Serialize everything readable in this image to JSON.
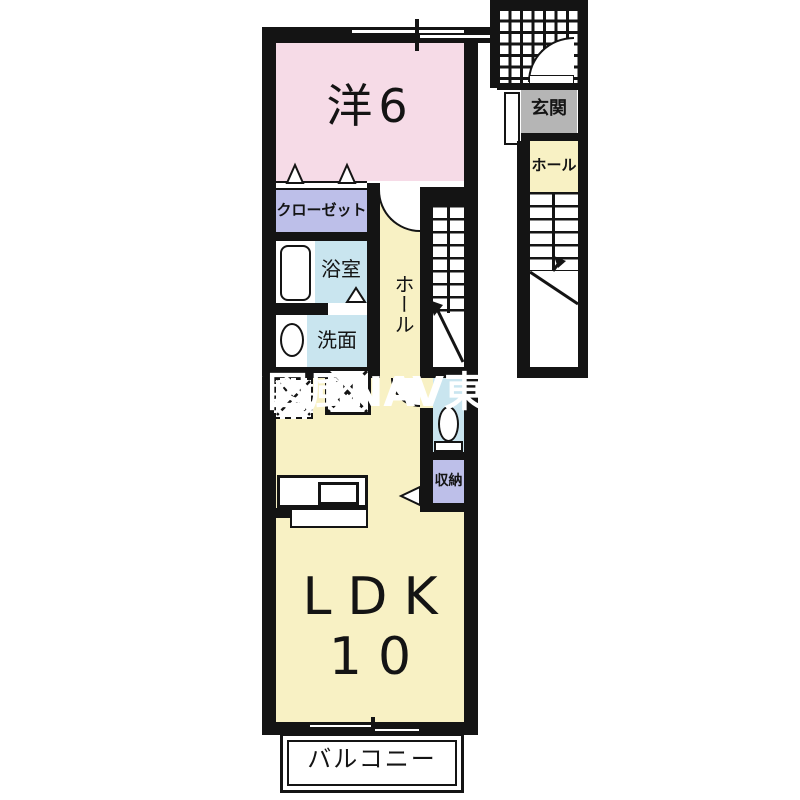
{
  "floorplan": {
    "rooms": {
      "western_room": {
        "label": "洋6"
      },
      "closet": {
        "label": "クローゼット"
      },
      "bathroom": {
        "label": "浴室"
      },
      "washroom": {
        "label": "洗面"
      },
      "hall": {
        "label": "ホール"
      },
      "storage": {
        "label": "収納"
      },
      "ldk": {
        "name": "LDK",
        "size": "10"
      },
      "balcony": {
        "label": "バルコニー"
      },
      "entrance": {
        "label": "玄関"
      },
      "entrance_hall": {
        "label": "ホール"
      }
    },
    "watermark": {
      "text": "イ図風NAV東P",
      "color": "#ffffff"
    },
    "colors": {
      "room_pink": "#f6dbe7",
      "room_yellow": "#f8f1c4",
      "room_blue": "#c9e5ef",
      "room_lavender": "#bdbfe9",
      "entrance_gray": "#b5b5b5",
      "wall": "#141414",
      "background": "#ffffff"
    },
    "symbols": {
      "bathtub": "rounded-rectangle",
      "washbasin": "ellipse",
      "toilet": "ellipse-with-tank",
      "kitchen-sink": "inset-rectangle",
      "stairs": "treads-with-direction-line-and-arrow",
      "door-swing": "quarter-circle-arc",
      "folding-door": "triangle-markers",
      "appliance-space": "box-with-dashed-x",
      "porch-tile": "grid-hatch"
    }
  }
}
